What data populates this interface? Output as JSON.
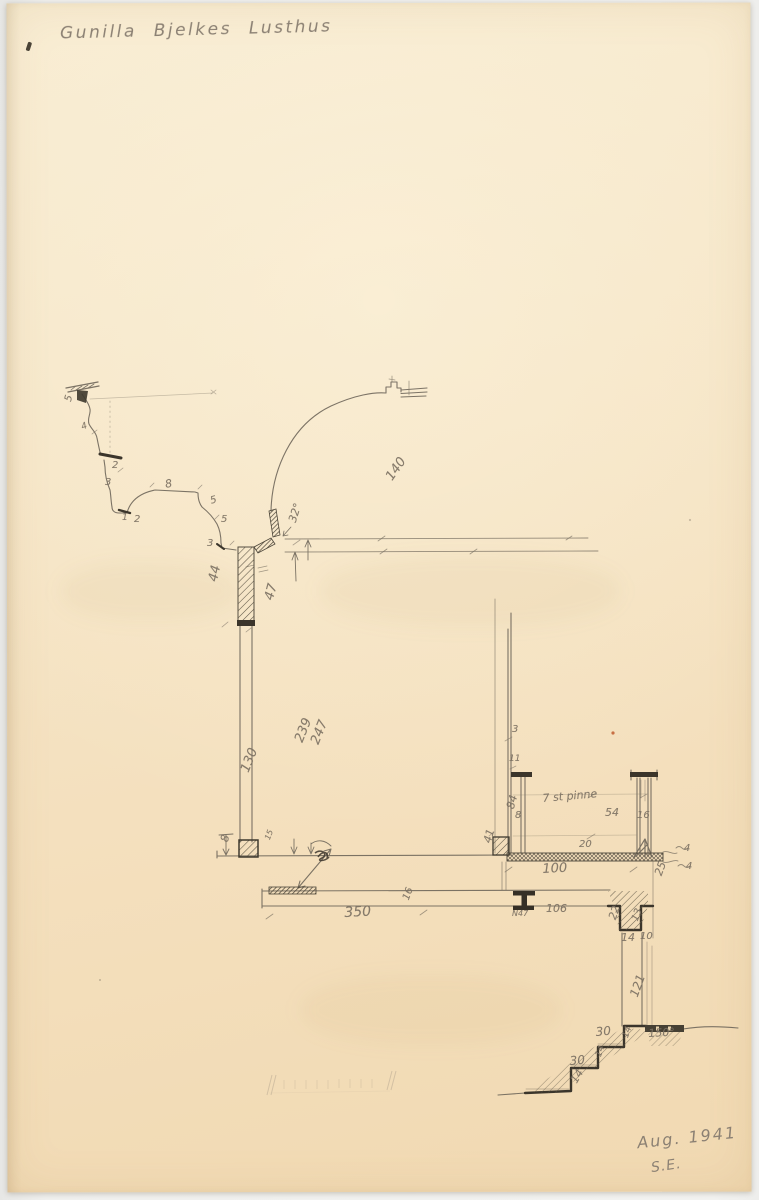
{
  "document": {
    "title": "Gunilla Bjelkes Lusthus",
    "date": "Aug. 1941",
    "initials": "S.E."
  },
  "colors": {
    "paper": "#f5e2c2",
    "pencil": "#6e665a",
    "dark_ink": "#3b352b"
  },
  "annotations": [
    {
      "text": "5",
      "x": 63,
      "y": 410,
      "rot": -75,
      "size": 10
    },
    {
      "text": "4",
      "x": 80,
      "y": 432,
      "rot": -20,
      "size": 9
    },
    {
      "text": "2",
      "x": 112,
      "y": 470,
      "rot": 0,
      "size": 10
    },
    {
      "text": "3",
      "x": 105,
      "y": 487,
      "rot": 0,
      "size": 10
    },
    {
      "text": "8",
      "x": 164,
      "y": 490,
      "rot": -10,
      "size": 11
    },
    {
      "text": "1",
      "x": 122,
      "y": 522,
      "rot": 0,
      "size": 9
    },
    {
      "text": "2",
      "x": 134,
      "y": 524,
      "rot": 0,
      "size": 10
    },
    {
      "text": "5",
      "x": 209,
      "y": 506,
      "rot": -15,
      "size": 10
    },
    {
      "text": "5",
      "x": 221,
      "y": 524,
      "rot": 0,
      "size": 10
    },
    {
      "text": "3",
      "x": 207,
      "y": 548,
      "rot": 0,
      "size": 10
    },
    {
      "text": "32°",
      "x": 286,
      "y": 532,
      "rot": -72,
      "size": 11
    },
    {
      "text": "44",
      "x": 206,
      "y": 594,
      "rot": -78,
      "size": 13
    },
    {
      "text": "47",
      "x": 262,
      "y": 612,
      "rot": -75,
      "size": 13
    },
    {
      "text": "140",
      "x": 383,
      "y": 489,
      "rot": -55,
      "size": 13
    },
    {
      "text": "239",
      "x": 292,
      "y": 753,
      "rot": -68,
      "size": 13
    },
    {
      "text": "247",
      "x": 308,
      "y": 755,
      "rot": -68,
      "size": 13
    },
    {
      "text": "130",
      "x": 238,
      "y": 783,
      "rot": -68,
      "size": 13
    },
    {
      "text": "8",
      "x": 218,
      "y": 852,
      "rot": -75,
      "size": 11
    },
    {
      "text": "15",
      "x": 263,
      "y": 846,
      "rot": -70,
      "size": 8
    },
    {
      "text": "3",
      "x": 512,
      "y": 734,
      "rot": 0,
      "size": 10
    },
    {
      "text": "11",
      "x": 509,
      "y": 763,
      "rot": 0,
      "size": 9
    },
    {
      "text": "84",
      "x": 504,
      "y": 819,
      "rot": -75,
      "size": 11
    },
    {
      "text": "8",
      "x": 515,
      "y": 820,
      "rot": 0,
      "size": 10
    },
    {
      "text": "7 st pinne",
      "x": 542,
      "y": 804,
      "rot": -5,
      "size": 11
    },
    {
      "text": "54",
      "x": 605,
      "y": 818,
      "rot": 0,
      "size": 11
    },
    {
      "text": "16",
      "x": 637,
      "y": 820,
      "rot": 0,
      "size": 10
    },
    {
      "text": "20",
      "x": 579,
      "y": 849,
      "rot": 0,
      "size": 10
    },
    {
      "text": "41",
      "x": 481,
      "y": 853,
      "rot": -75,
      "size": 11
    },
    {
      "text": "100",
      "x": 542,
      "y": 876,
      "rot": -3,
      "size": 13
    },
    {
      "text": "4",
      "x": 684,
      "y": 853,
      "rot": 0,
      "size": 10
    },
    {
      "text": "4",
      "x": 686,
      "y": 871,
      "rot": 0,
      "size": 10
    },
    {
      "text": "350",
      "x": 344,
      "y": 920,
      "rot": -3,
      "size": 14
    },
    {
      "text": "16",
      "x": 401,
      "y": 908,
      "rot": -70,
      "size": 10
    },
    {
      "text": "N47",
      "x": 512,
      "y": 917,
      "rot": 0,
      "size": 8
    },
    {
      "text": "106",
      "x": 546,
      "y": 914,
      "rot": 0,
      "size": 11
    },
    {
      "text": "22",
      "x": 606,
      "y": 929,
      "rot": -70,
      "size": 11
    },
    {
      "text": "13",
      "x": 630,
      "y": 929,
      "rot": -70,
      "size": 10
    },
    {
      "text": "14",
      "x": 621,
      "y": 943,
      "rot": 0,
      "size": 11
    },
    {
      "text": "10",
      "x": 640,
      "y": 941,
      "rot": 0,
      "size": 10
    },
    {
      "text": "25",
      "x": 652,
      "y": 885,
      "rot": -70,
      "size": 11
    },
    {
      "text": "121",
      "x": 627,
      "y": 1007,
      "rot": -70,
      "size": 12
    },
    {
      "text": "30",
      "x": 595,
      "y": 1038,
      "rot": -5,
      "size": 12
    },
    {
      "text": "30",
      "x": 569,
      "y": 1067,
      "rot": -5,
      "size": 12
    },
    {
      "text": "14",
      "x": 568,
      "y": 1091,
      "rot": -60,
      "size": 11
    },
    {
      "text": "14",
      "x": 621,
      "y": 1045,
      "rot": -70,
      "size": 9
    },
    {
      "text": "14",
      "x": 594,
      "y": 1064,
      "rot": -70,
      "size": 9
    },
    {
      "text": "150°",
      "x": 648,
      "y": 1039,
      "rot": -3,
      "size": 11
    }
  ]
}
